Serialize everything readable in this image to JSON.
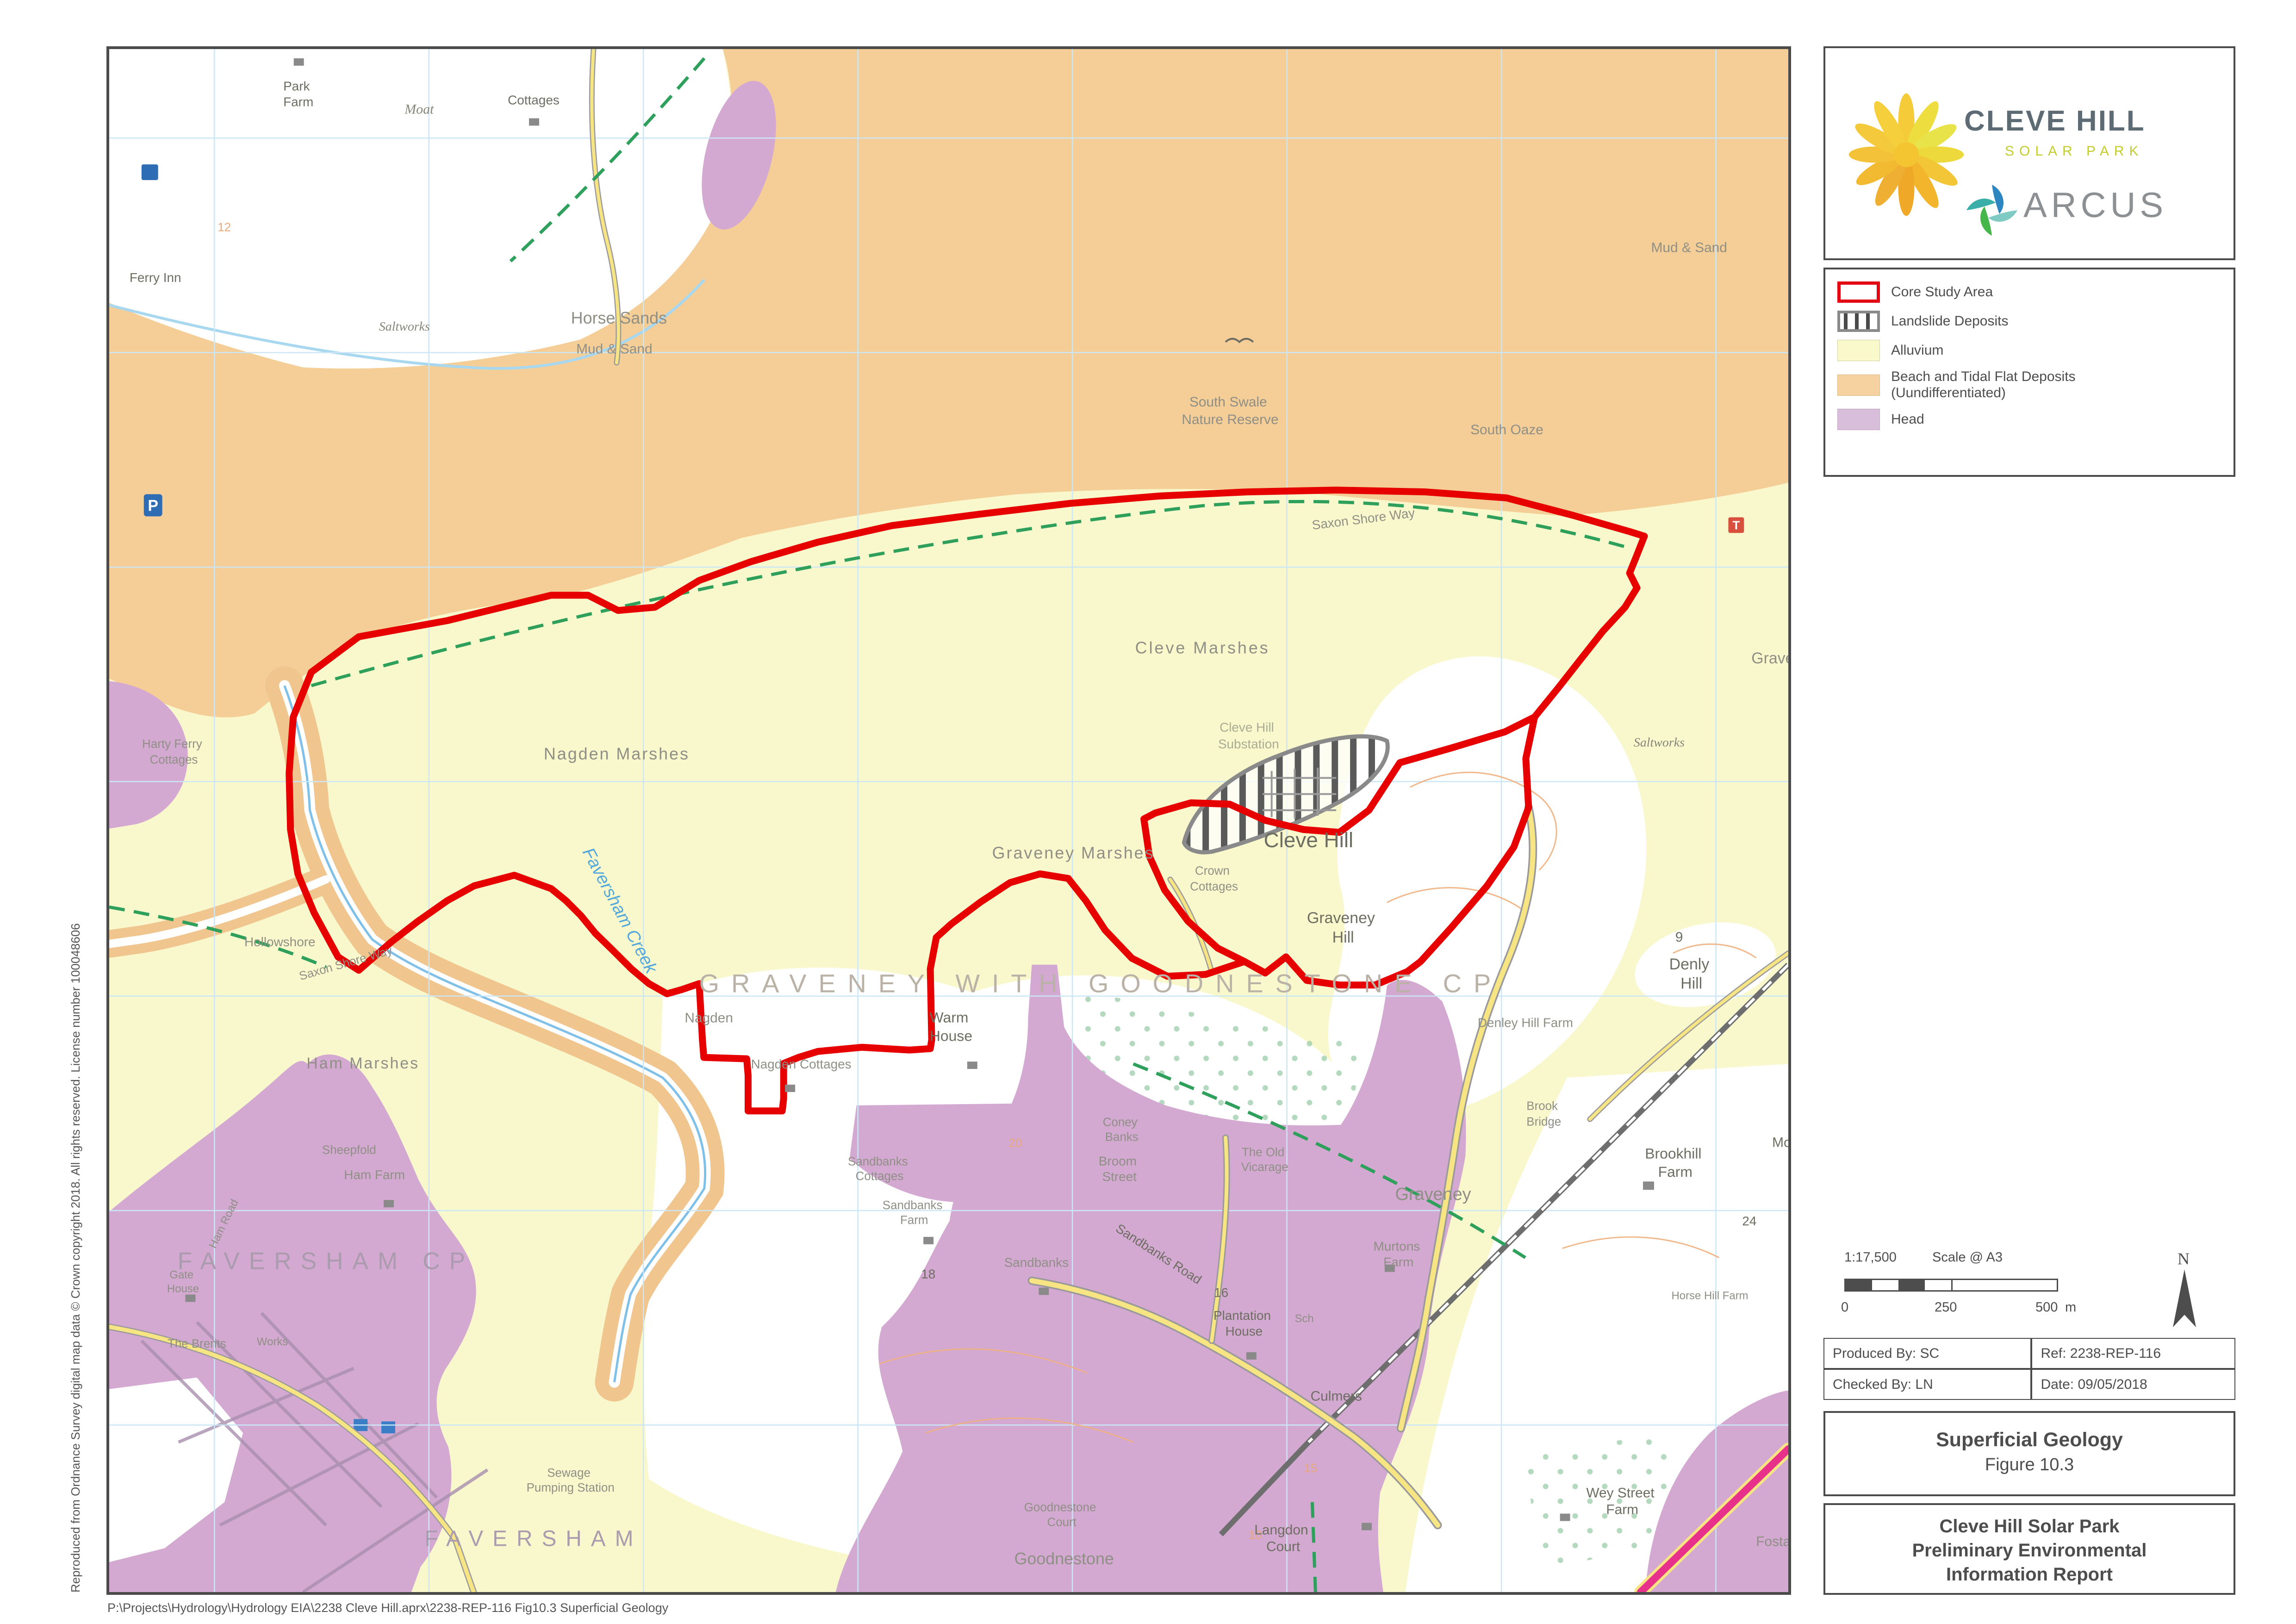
{
  "page": {
    "file_path": "P:\\Projects\\Hydrology\\Hydrology EIA\\2238 Cleve Hill.aprx\\2238-REP-116 Fig10.3 Superficial Geology",
    "copyright_vertical": "Reproduced from Ordnance Survey digital map data © Crown copyright 2018. All rights reserved. License number 100048606"
  },
  "sidebar": {
    "logo_cleve": {
      "title": "CLEVE HILL",
      "subtitle": "SOLAR PARK"
    },
    "logo_arcus": {
      "text": "ARCUS"
    },
    "legend": {
      "items": [
        {
          "label": "Core Study Area"
        },
        {
          "label": "Landslide Deposits"
        },
        {
          "label": "Alluvium"
        },
        {
          "label": "Beach and Tidal Flat Deposits",
          "label2": "(Uundifferentiated)"
        },
        {
          "label": "Head"
        }
      ]
    },
    "scale": {
      "ratio": "1:17,500",
      "at": "Scale @ A3",
      "tick0": "0",
      "tick250": "250",
      "tick500": "500",
      "unit": "m",
      "north": "N"
    },
    "meta": {
      "produced_by": "Produced By: SC",
      "ref": "Ref: 2238-REP-116",
      "checked_by": "Checked By: LN",
      "date": "Date: 09/05/2018"
    },
    "figure": {
      "title": "Superficial Geology",
      "number": "Figure 10.3"
    },
    "report": {
      "line1": "Cleve Hill Solar Park",
      "line2": "Preliminary Environmental",
      "line3": "Information Report"
    }
  },
  "map": {
    "colors": {
      "core_study_area": "#E60000",
      "alluvium": "#F9F8CD",
      "beach_tidal": "#F5CE97",
      "head": "#D3A9D2",
      "landslide_outline": "#8a8a8a",
      "road_yellow": "#F7E584",
      "road_magenta": "#E8318A",
      "railway": "#6e6e6e",
      "footpath_green": "#2FA05C",
      "water": "#A8D8F0",
      "grid": "#CBE6F7",
      "contour": "#F0B080"
    },
    "labels": {
      "park_farm_1": "Park",
      "park_farm_2": "Farm",
      "moat": "Moat",
      "cottages_nw": "Cottages",
      "ferry_inn": "Ferry Inn",
      "saltworks_nw": "Saltworks",
      "contour_12": "12",
      "horse_sands": "Horse Sands",
      "horse_sands_sub": "Mud & Sand",
      "mud_sand_ne": "Mud & Sand",
      "south_swale_1": "South Swale",
      "south_swale_2": "Nature Reserve",
      "south_oaze": "South Oaze",
      "saxon_shore_way_top": "Saxon Shore Way",
      "saxon_shore_way_west": "Saxon Shore Way",
      "cleve_marshes": "Cleve Marshes",
      "graveney_ne": "Graveney",
      "saltworks_e": "Saltworks",
      "nagden_marshes": "Nagden Marshes",
      "harty_ferry_1": "Harty Ferry",
      "harty_ferry_2": "Cottages",
      "cleve_hill_substation_1": "Cleve Hill",
      "cleve_hill_substation_2": "Substation",
      "cleve_hill": "Cleve Hill",
      "crown_cottages_1": "Crown",
      "crown_cottages_2": "Cottages",
      "graveney_marshes": "Graveney Marshes",
      "graveney_hill_1": "Graveney",
      "graveney_hill_2": "Hill",
      "faversham_creek": "Faversham Creek",
      "hollowshore": "Hollowshore",
      "parish_cp": "GRAVENEY WITH GOODNESTONE CP",
      "nagden": "Nagden",
      "nagden_cottages": "Nagden Cottages",
      "warm_house_1": "Warm",
      "warm_house_2": "House",
      "denly_spot": "9",
      "denly_hill_1": "Denly",
      "denly_hill_2": "Hill",
      "denley_hill_farm": "Denley Hill Farm",
      "ham_marshes": "Ham Marshes",
      "sheepfold": "Sheepfold",
      "ham_farm": "Ham Farm",
      "ham_road": "Ham Road",
      "brook_bridge_1": "Brook",
      "brook_bridge_2": "Bridge",
      "brookhill_farm_1": "Brookhill",
      "brookhill_farm_2": "Farm",
      "monkshill": "Mo",
      "coney_banks_1": "Coney",
      "coney_banks_2": "Banks",
      "broom_street_1": "Broom",
      "broom_street_2": "Street",
      "old_vicarage_1": "The Old",
      "old_vicarage_2": "Vicarage",
      "sandbanks_cottages_1": "Sandbanks",
      "sandbanks_cottages_2": "Cottages",
      "sandbanks_farm_1": "Sandbanks",
      "sandbanks_farm_2": "Farm",
      "sandbanks": "Sandbanks",
      "sandbanks_road": "Sandbanks Road",
      "num_18": "18",
      "num_16": "16",
      "num_24": "24",
      "contour_20": "20",
      "contour_15": "15",
      "contour_10": "10",
      "faversham_cp": "FAVERSHAM CP",
      "gate_house_1": "Gate",
      "gate_house_2": "House",
      "the_brents": "The Brents",
      "works": "Works",
      "graveney_village": "Graveney",
      "murtons_farm_1": "Murtons",
      "murtons_farm_2": "Farm",
      "school": "Sch",
      "horse_hill_farm": "Horse Hill Farm",
      "plantation_house_1": "Plantation",
      "plantation_house_2": "House",
      "culmers": "Culmers",
      "sewage_1": "Sewage",
      "sewage_2": "Pumping Station",
      "faversham_town": "FAVERSHAM",
      "goodnestone_court_1": "Goodnestone",
      "goodnestone_court_2": "Court",
      "goodnestone": "Goodnestone",
      "langdon_court_1": "Langdon",
      "langdon_court_2": "Court",
      "wey_street_farm_1": "Wey Street",
      "wey_street_farm_2": "Farm",
      "fostall": "Fostall",
      "parking": "P",
      "telephone": "T"
    }
  }
}
